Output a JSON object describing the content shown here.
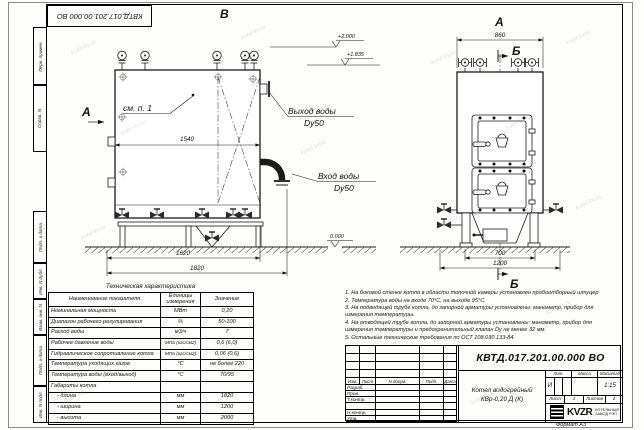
{
  "watermark": {
    "text": "kotel-kv.ru"
  },
  "frame": {
    "corner_stamp": "КВТД.017.201.00.000 ВО",
    "side_stamps": {
      "perv_primen": "Перв. примен.",
      "sprav_no": "Справ. N",
      "podp_data_1": "Подп. и дата",
      "inv_dubl": "Инв. N дубл.",
      "vzam_inv": "Взам. инв. N",
      "podp_data_2": "Подп. и дата",
      "inv_podl": "Инв. N подл.",
      "format_note": "Формат А3"
    }
  },
  "views": {
    "side_view": {
      "label_top": "В",
      "label_left": "А",
      "detail_note": "см. п. 1",
      "dim_width": "1540",
      "dim_base": "1620",
      "dim_total": "1820",
      "elevation_zero": "0.000"
    },
    "front_view": {
      "label_top": "А",
      "section_label": "Б",
      "dim_width": "860",
      "dim_inner": "700",
      "dim_total": "1200"
    },
    "elevations": {
      "top": "+2.000",
      "outlet": "+1.835"
    },
    "labels": {
      "outlet_line1": "Выход воды",
      "outlet_line2": "Dy50",
      "inlet_line1": "Вход воды",
      "inlet_line2": "Dy50"
    }
  },
  "tech_table": {
    "title": "Техническая характеристика",
    "headers": [
      "Наименование показателя",
      "Единицы измерения",
      "Значение"
    ],
    "rows": [
      {
        "name": "Номинальная мощность",
        "unit": "МВт",
        "value": "0,20"
      },
      {
        "name": "Диапазон рабочего регулирования",
        "unit": "%",
        "value": "50-100"
      },
      {
        "name": "Расход воды",
        "unit": "м3/ч",
        "value": "7"
      },
      {
        "name": "Рабочее давление воды",
        "unit": "МПа (кгс/см2)",
        "value": "0,6 (6,0)"
      },
      {
        "name": "Гидравлическое сопротивление котла",
        "unit": "МПа (кгс/см2)",
        "value": "0,06 (0,6)"
      },
      {
        "name": "Температура уходящих газов",
        "unit": "°С",
        "value": "не более 220"
      },
      {
        "name": "Температура воды (вход/выход)",
        "unit": "°С",
        "value": "70/95"
      },
      {
        "name": "Габариты котла",
        "unit": "",
        "value": ""
      },
      {
        "name": "- длина",
        "unit": "мм",
        "value": "1820"
      },
      {
        "name": "- ширина",
        "unit": "мм",
        "value": "1200"
      },
      {
        "name": "- высота",
        "unit": "мм",
        "value": "2000"
      }
    ]
  },
  "notes": [
    "1. На боковой стенке котла в области топочной камеры установлен пробоотборный штуцер",
    "2. Температура воды на входе 70°С, на выходе 95°С.",
    "3. На подводящей трубе котла, до запорной арматуры установлены: манометр, прибор для измерения температуры.",
    "4. На отводящей трубе котла, до запорной арматуры установлены: манометр, прибор для измерения температуры и предохранительный клапан Dу не менее 32 мм.",
    "5. Остальные технические требования по ОСТ 108.030.133-84."
  ],
  "title_block": {
    "doc_number": "КВТД.017.201.00.000 ВО",
    "product_name_line1": "Котел водогрейный",
    "product_name_line2": "КВр-0,20 Д (К)",
    "col_izm": "Изм.",
    "col_list": "Лист",
    "col_doc": "N докум.",
    "col_podp": "Подп.",
    "col_data": "Дата",
    "row_razrab": "Разраб.",
    "row_prov": "Пров.",
    "row_tkontr": "Т.контр.",
    "row_nkontr": "Н.контр.",
    "row_utv": "Утв.",
    "lit_label": "Лит.",
    "lit_value": "И",
    "massa_label": "Масса",
    "masshtab_label": "Масштаб",
    "masshtab_value": "1:15",
    "list_label": "Лист",
    "list_value": "1",
    "listov_label": "Листов",
    "listov_value": "2",
    "company_logo": "KVZR",
    "company_line1": "КОТЕЛЬНЫЙ",
    "company_line2": "ЗАВОД РЭП"
  }
}
